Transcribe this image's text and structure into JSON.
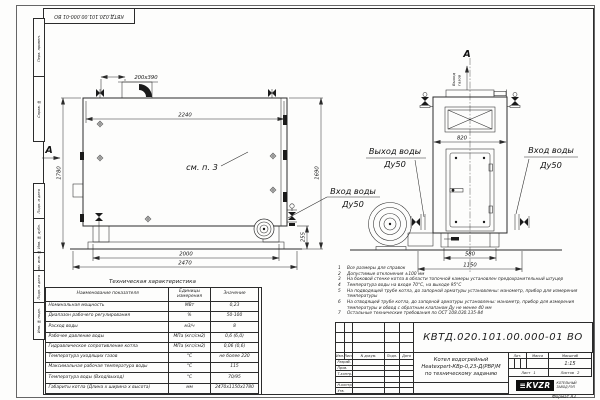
{
  "sheet": {
    "stamp_top": "КВТД.020.101.00.000-01 ВО",
    "format_note": "Формат А3",
    "margin_stamps": [
      "Перв. примен.",
      "Справ. №",
      "Подп. и дата",
      "Инв. № дубл.",
      "Взам. инв. №",
      "Подп. и дата",
      "Инв. № подл."
    ]
  },
  "drawing": {
    "section_mark": "А",
    "view_mark": "А",
    "see_note": "см. п. 3",
    "gas_out_word1": "Выход",
    "gas_out_word2": "газов",
    "labels": {
      "inlet_side": {
        "line1": "Вход воды",
        "line2": "Ду50"
      },
      "outlet_front": {
        "line1": "Выход воды",
        "line2": "Ду50"
      },
      "inlet_front": {
        "line1": "Вход воды",
        "line2": "Ду50"
      }
    },
    "dims": {
      "stub": "200х390",
      "inner_width": "2240",
      "height_left": "1780",
      "height_right": "1690",
      "base_height": "255",
      "support_width": "2000",
      "overall_length": "2470",
      "front_width": "820",
      "front_base": "580",
      "front_overall": "1150"
    }
  },
  "tech_table": {
    "title": "Техническая характеристика",
    "headers": [
      "Наименование показателя",
      "Единицы измерения",
      "Значение"
    ],
    "rows": [
      [
        "Номинальная мощность",
        "МВт",
        "0,23"
      ],
      [
        "Диапазон рабочего регулирования",
        "%",
        "50-100"
      ],
      [
        "Расход воды",
        "м3/ч",
        "8"
      ],
      [
        "Рабочее давление воды",
        "МПа (кгс/см2)",
        "0,6 (6,0)"
      ],
      [
        "Гидравлическое сопротивление котла",
        "МПа (кгс/см2)",
        "0,06 (0,6)"
      ],
      [
        "Температура уходящих газов",
        "°С",
        "не более 220"
      ],
      [
        "Максимальная рабочая температура воды",
        "°С",
        "115"
      ],
      [
        "Температура воды (Вход/выход)",
        "°С",
        "70/95"
      ],
      [
        "Габариты котла (Длина х ширина х высота)",
        "мм",
        "2470х1150х1780"
      ]
    ]
  },
  "notes": [
    {
      "n": "1",
      "t": "Все размеры для справок"
    },
    {
      "n": "2",
      "t": "Допустимые отклонения ±100 мм"
    },
    {
      "n": "3",
      "t": "На боковой стенке котла в области топочной камеры установлен предохранительный штуцер"
    },
    {
      "n": "4",
      "t": "Температура воды на входе 70°С, на выходе 95°С"
    },
    {
      "n": "5",
      "t": "На подводящей трубе котла, до запорной арматуры установлены: манометр, прибор для измерения температуры"
    },
    {
      "n": "6",
      "t": "На отводящей трубе котла, до запорной арматуры установлены: манометр, прибор для измерения температуры и обвод с обратным клапаном Ду не менее 40 мм"
    },
    {
      "n": "7",
      "t": "Остальные технические требования по ОСТ 108.030.135-84"
    }
  ],
  "title_block": {
    "doc_number": "КВТД.020.101.00.000-01  ВО",
    "product_line1": "Котел водогрейный",
    "product_line2": "Heatexpert-КВр-0,23-Д(РВР)М",
    "product_line3": "по техническому заданию",
    "cols": {
      "izm": "Изм.",
      "list": "Лист",
      "doc": "N докум.",
      "podp": "Подп.",
      "data": "Дата"
    },
    "roles": [
      "Разраб.",
      "Пров.",
      "Т.контр.",
      "",
      "Н.контр.",
      "Утв."
    ],
    "lit": "Лит.",
    "mass": "Масса",
    "scale_label": "Масштаб",
    "scale": "1:15",
    "sheet": "Лист",
    "sheet_no": "1",
    "sheets": "Листов",
    "sheets_no": "2",
    "logo": "KVZR",
    "org1": "КОТЕЛЬНЫЙ",
    "org2": "ЗАВОД РЭП"
  }
}
